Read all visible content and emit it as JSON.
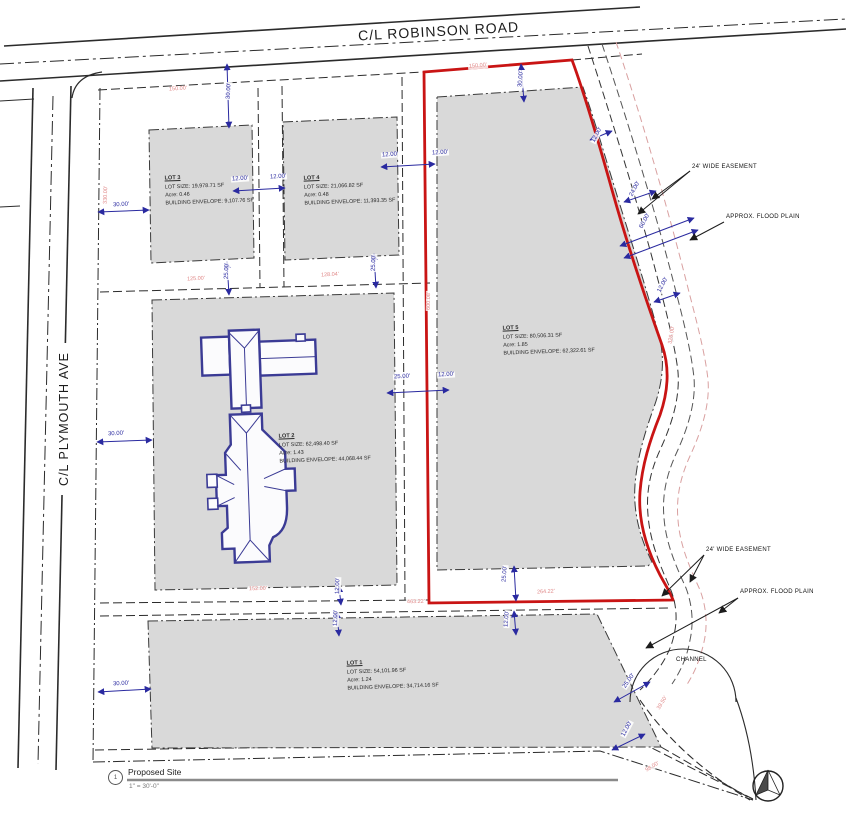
{
  "drawing": {
    "roads": {
      "robinson": "C/L ROBINSON ROAD",
      "plymouth": "C/L PLYMOUTH AVE"
    },
    "lots": {
      "lot1": {
        "name": "LOT 1",
        "size": "LOT SIZE: 54,101.96 SF",
        "acre": "Acre: 1.24",
        "envelope": "BUILDING ENVELOPE: 34,714.16 SF"
      },
      "lot2": {
        "name": "LOT 2",
        "size": "LOT SIZE: 62,498.40 SF",
        "acre": "Acre: 1.43",
        "envelope": "BUILDING ENVELOPE: 44,068.44 SF"
      },
      "lot3": {
        "name": "LOT 3",
        "size": "LOT SIZE: 19,978.71 SF",
        "acre": "Acre: 0.46",
        "envelope": "BUILDING ENVELOPE: 9,107.76 SF"
      },
      "lot4": {
        "name": "LOT 4",
        "size": "LOT SIZE: 21,066.82 SF",
        "acre": "Acre: 0.48",
        "envelope": "BUILDING ENVELOPE: 11,393.35 SF"
      },
      "lot5": {
        "name": "LOT 5",
        "size": "LOT SIZE: 80,506.31 SF",
        "acre": "Acre: 1.85",
        "envelope": "BUILDING ENVELOPE: 62,322.61 SF"
      }
    },
    "annotations": {
      "easement_upper": "24' WIDE EASEMENT",
      "flood_upper": "APPROX. FLOOD PLAIN",
      "easement_lower": "24' WIDE EASEMENT",
      "flood_lower": "APPROX. FLOOD PLAIN",
      "channel": "CHANNEL"
    },
    "legend": {
      "marker": "1",
      "title": "Proposed Site",
      "scale": "1\" = 30'-0\""
    }
  },
  "colors": {
    "lot_fill": "#d9d9d9",
    "boundary_red": "#c91414",
    "dimension_blue": "#2a2aa0",
    "dimension_red_text": "#e08888",
    "house_blue": "#3b3b95",
    "line_black": "#2b2b2b"
  },
  "dimensions": [
    {
      "t": "30.00'",
      "x": 220,
      "y": 88,
      "r": -87,
      "c": "b"
    },
    {
      "t": "12.00'",
      "x": 231,
      "y": 176,
      "r": -4,
      "c": "b"
    },
    {
      "t": "12.00'",
      "x": 269,
      "y": 174,
      "r": -4,
      "c": "b"
    },
    {
      "t": "12.00'",
      "x": 381,
      "y": 152,
      "r": -4,
      "c": "b"
    },
    {
      "t": "12.00'",
      "x": 431,
      "y": 150,
      "r": -4,
      "c": "b"
    },
    {
      "t": "30.00'",
      "x": 512,
      "y": 76,
      "r": -85,
      "c": "b"
    },
    {
      "t": "30.00'",
      "x": 112,
      "y": 202,
      "r": -3,
      "c": "b"
    },
    {
      "t": "30.00'",
      "x": 107,
      "y": 431,
      "r": -3,
      "c": "b"
    },
    {
      "t": "30.00'",
      "x": 112,
      "y": 681,
      "r": -3,
      "c": "b"
    },
    {
      "t": "25.00'",
      "x": 218,
      "y": 268,
      "r": -88,
      "c": "b"
    },
    {
      "t": "25.00'",
      "x": 365,
      "y": 260,
      "r": -88,
      "c": "b"
    },
    {
      "t": "25.00'",
      "x": 393,
      "y": 374,
      "r": -3,
      "c": "b"
    },
    {
      "t": "12.00'",
      "x": 437,
      "y": 372,
      "r": -3,
      "c": "b"
    },
    {
      "t": "25.00'",
      "x": 496,
      "y": 571,
      "r": -86,
      "c": "b"
    },
    {
      "t": "12.00'",
      "x": 498,
      "y": 616,
      "r": -86,
      "c": "b"
    },
    {
      "t": "12.00'",
      "x": 329,
      "y": 583,
      "r": -88,
      "c": "b"
    },
    {
      "t": "12.00'",
      "x": 327,
      "y": 615,
      "r": -88,
      "c": "b"
    },
    {
      "t": "12.00'",
      "x": 588,
      "y": 132,
      "r": -62,
      "c": "b"
    },
    {
      "t": "24.00'",
      "x": 626,
      "y": 186,
      "r": -62,
      "c": "b"
    },
    {
      "t": "60.00'",
      "x": 636,
      "y": 218,
      "r": -62,
      "c": "b"
    },
    {
      "t": "12.00'",
      "x": 654,
      "y": 282,
      "r": -62,
      "c": "b"
    },
    {
      "t": "25.00'",
      "x": 620,
      "y": 678,
      "r": -55,
      "c": "b"
    },
    {
      "t": "12.00'",
      "x": 618,
      "y": 726,
      "r": -62,
      "c": "b"
    },
    {
      "t": "150.00'",
      "x": 168,
      "y": 86,
      "r": -4,
      "c": "r"
    },
    {
      "t": "150.00'",
      "x": 468,
      "y": 63,
      "r": -5,
      "c": "r"
    },
    {
      "t": "125.00'",
      "x": 186,
      "y": 276,
      "r": -3,
      "c": "r"
    },
    {
      "t": "128.04'",
      "x": 320,
      "y": 272,
      "r": -3,
      "c": "r"
    },
    {
      "t": "330.00'",
      "x": 96,
      "y": 192,
      "r": -88,
      "c": "r"
    },
    {
      "t": "600.08'",
      "x": 419,
      "y": 298,
      "r": -89,
      "c": "r"
    },
    {
      "t": "152.00'",
      "x": 248,
      "y": 586,
      "r": -2,
      "c": "r"
    },
    {
      "t": "463.22'",
      "x": 406,
      "y": 599,
      "r": -2,
      "c": "r"
    },
    {
      "t": "264.22'",
      "x": 536,
      "y": 589,
      "r": -3,
      "c": "r"
    },
    {
      "t": "326.00'",
      "x": 662,
      "y": 332,
      "r": -80,
      "c": "r"
    },
    {
      "t": "39.50'",
      "x": 654,
      "y": 700,
      "r": -58,
      "c": "r"
    },
    {
      "t": "98.00'",
      "x": 644,
      "y": 764,
      "r": -32,
      "c": "r"
    }
  ]
}
